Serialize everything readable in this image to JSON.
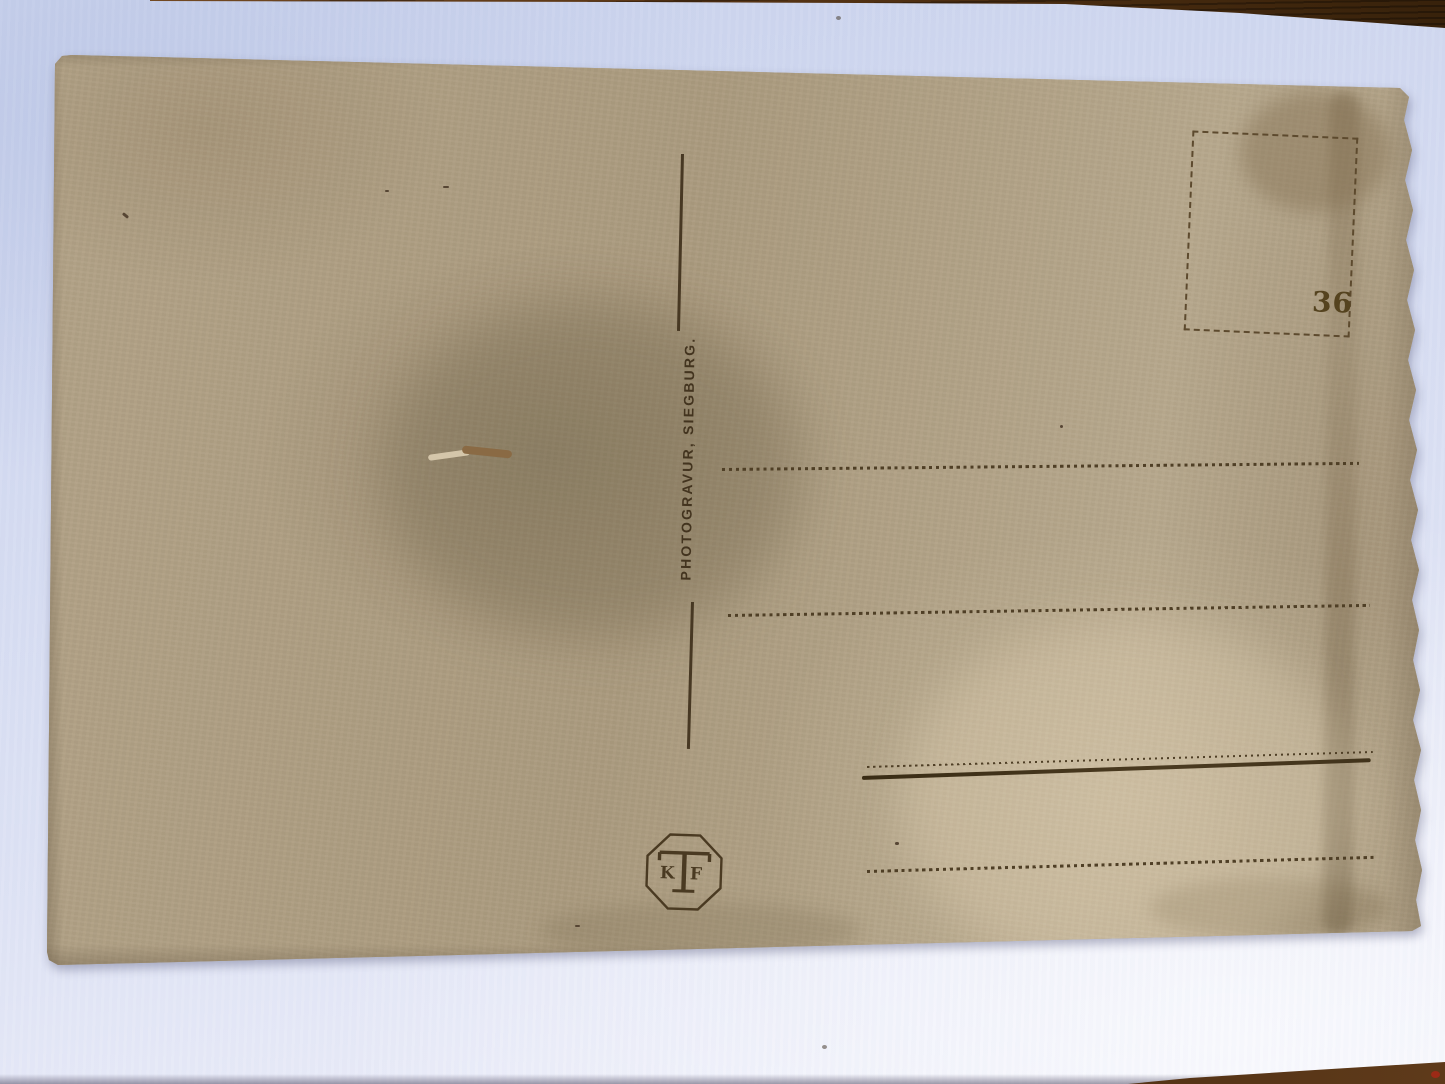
{
  "scene": {
    "type": "photograph",
    "subject": "Back of a blank antique postcard lying on a pale lavender backdrop",
    "backdrop_color": "#d6dcf2",
    "table_wood_color": "#4a2c12",
    "table_edges_visible": "top-right and bottom-right corners"
  },
  "postcard": {
    "paper_color": "#ad9e83",
    "ink_color": "#47381f",
    "publisher_line": "PHOTOGRAVUR, SIEGBURG.",
    "stamp_box": {
      "number": "36"
    },
    "logo": {
      "shape": "octagon",
      "letters": {
        "left": "K",
        "center": "T",
        "right": "F"
      }
    },
    "address_line_count": 4
  }
}
